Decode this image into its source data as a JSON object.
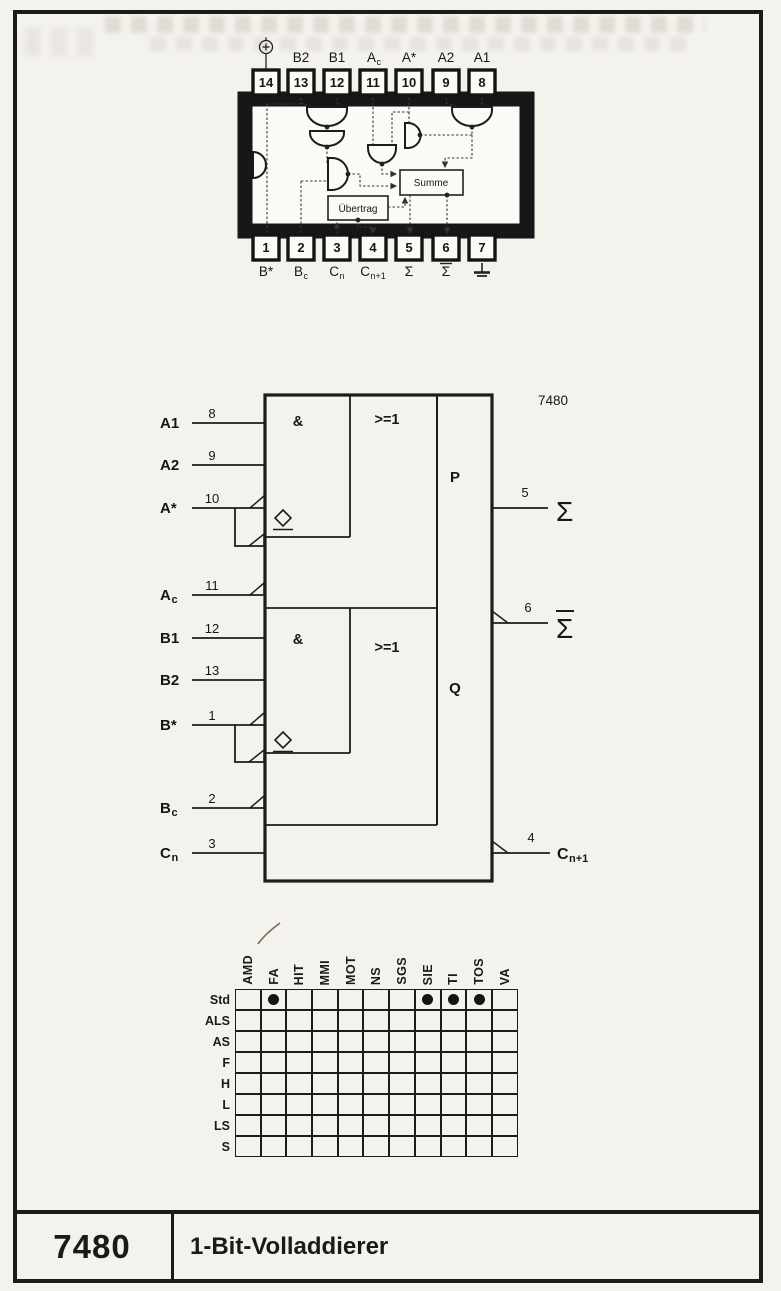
{
  "pinout": {
    "rotated_chip_id": "7480",
    "sum_box_label": "Summe",
    "carry_box_label": "Übertrag",
    "top_pins": [
      {
        "num": "14",
        "symbol": "vcc"
      },
      {
        "num": "13",
        "label": "B2"
      },
      {
        "num": "12",
        "label": "B1"
      },
      {
        "num": "11",
        "label": "A",
        "sub": "c"
      },
      {
        "num": "10",
        "label": "A*"
      },
      {
        "num": "9",
        "label": "A2"
      },
      {
        "num": "8",
        "label": "A1"
      }
    ],
    "bottom_pins": [
      {
        "num": "1",
        "label": "B*"
      },
      {
        "num": "2",
        "label": "B",
        "sub": "c"
      },
      {
        "num": "3",
        "label": "C",
        "sub": "n"
      },
      {
        "num": "4",
        "label": "C",
        "sub": "n+1"
      },
      {
        "num": "5",
        "label": "Σ"
      },
      {
        "num": "6",
        "label": "Σ",
        "overbar": true
      },
      {
        "num": "7",
        "symbol": "ground"
      }
    ]
  },
  "logic_symbol": {
    "chip_id": "7480",
    "and_label": "&",
    "or_label": ">=1",
    "p_label": "P",
    "q_label": "Q",
    "inputs": [
      {
        "name": "A1",
        "pin": "8"
      },
      {
        "name": "A2",
        "pin": "9"
      },
      {
        "name": "A*",
        "pin": "10"
      },
      {
        "name": "A",
        "sub": "c",
        "pin": "11"
      },
      {
        "name": "B1",
        "pin": "12"
      },
      {
        "name": "B2",
        "pin": "13"
      },
      {
        "name": "B*",
        "pin": "1"
      },
      {
        "name": "B",
        "sub": "c",
        "pin": "2"
      },
      {
        "name": "C",
        "sub": "n",
        "pin": "3"
      }
    ],
    "outputs": [
      {
        "name": "Σ",
        "pin": "5"
      },
      {
        "name": "Σ",
        "overbar": true,
        "pin": "6"
      },
      {
        "name": "C",
        "sub": "n+1",
        "pin": "4"
      }
    ]
  },
  "availability_table": {
    "manufacturers": [
      "AMD",
      "FA",
      "HIT",
      "MMI",
      "MOT",
      "NS",
      "SGS",
      "SIE",
      "TI",
      "TOS",
      "VA"
    ],
    "families": [
      "Std",
      "ALS",
      "AS",
      "F",
      "H",
      "L",
      "LS",
      "S"
    ],
    "available": [
      {
        "family": "Std",
        "manufacturer": "FA"
      },
      {
        "family": "Std",
        "manufacturer": "SIE"
      },
      {
        "family": "Std",
        "manufacturer": "TI"
      },
      {
        "family": "Std",
        "manufacturer": "TOS"
      }
    ]
  },
  "footer": {
    "part_number": "7480",
    "title": "1-Bit-Volladdierer"
  }
}
